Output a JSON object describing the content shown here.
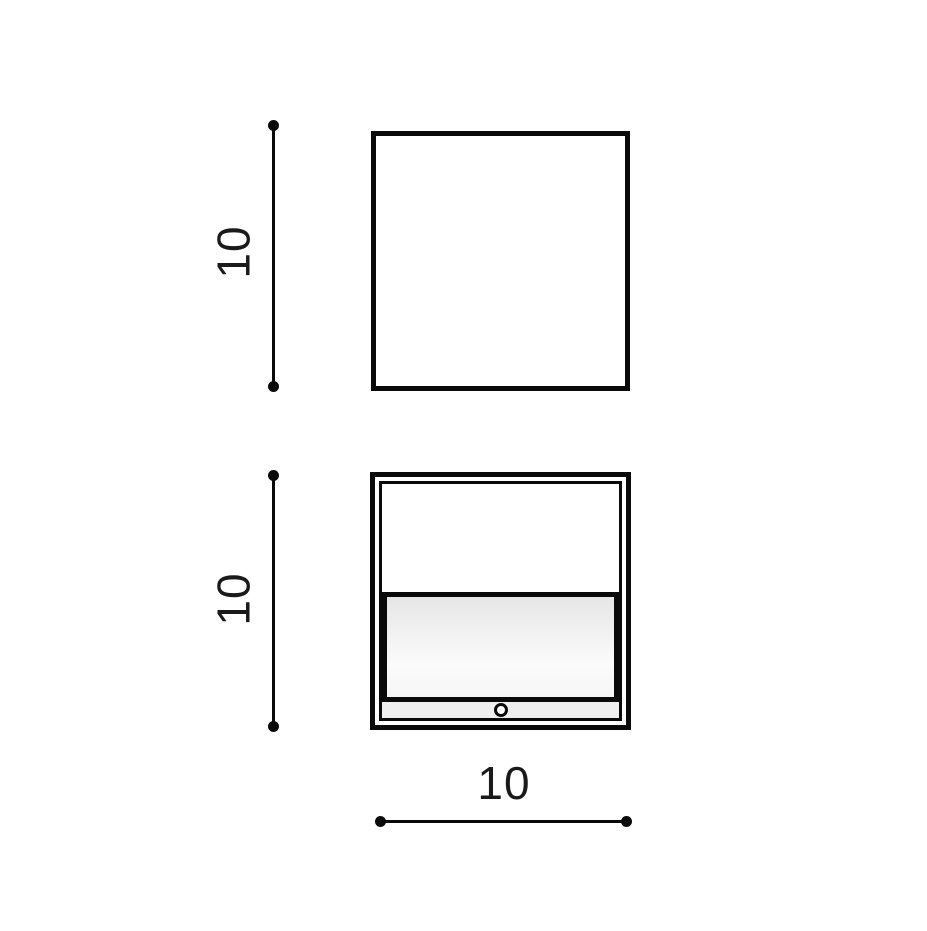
{
  "theme": {
    "bg": "#ffffff",
    "stroke": "#0a0a0a",
    "label-color": "#1a1a1a",
    "panel-top": "#e6e6e6",
    "panel-bottom": "#fbfbfb",
    "strip": "#efefef"
  },
  "drawing": {
    "views": {
      "top": {
        "name": "top view outline (empty square)"
      },
      "front": {
        "name": "front view with diffuser panel, bottom strip and mounting hole"
      }
    },
    "dimensions": {
      "top_height": {
        "label": "10"
      },
      "front_height": {
        "label": "10"
      },
      "front_width": {
        "label": "10"
      }
    }
  }
}
